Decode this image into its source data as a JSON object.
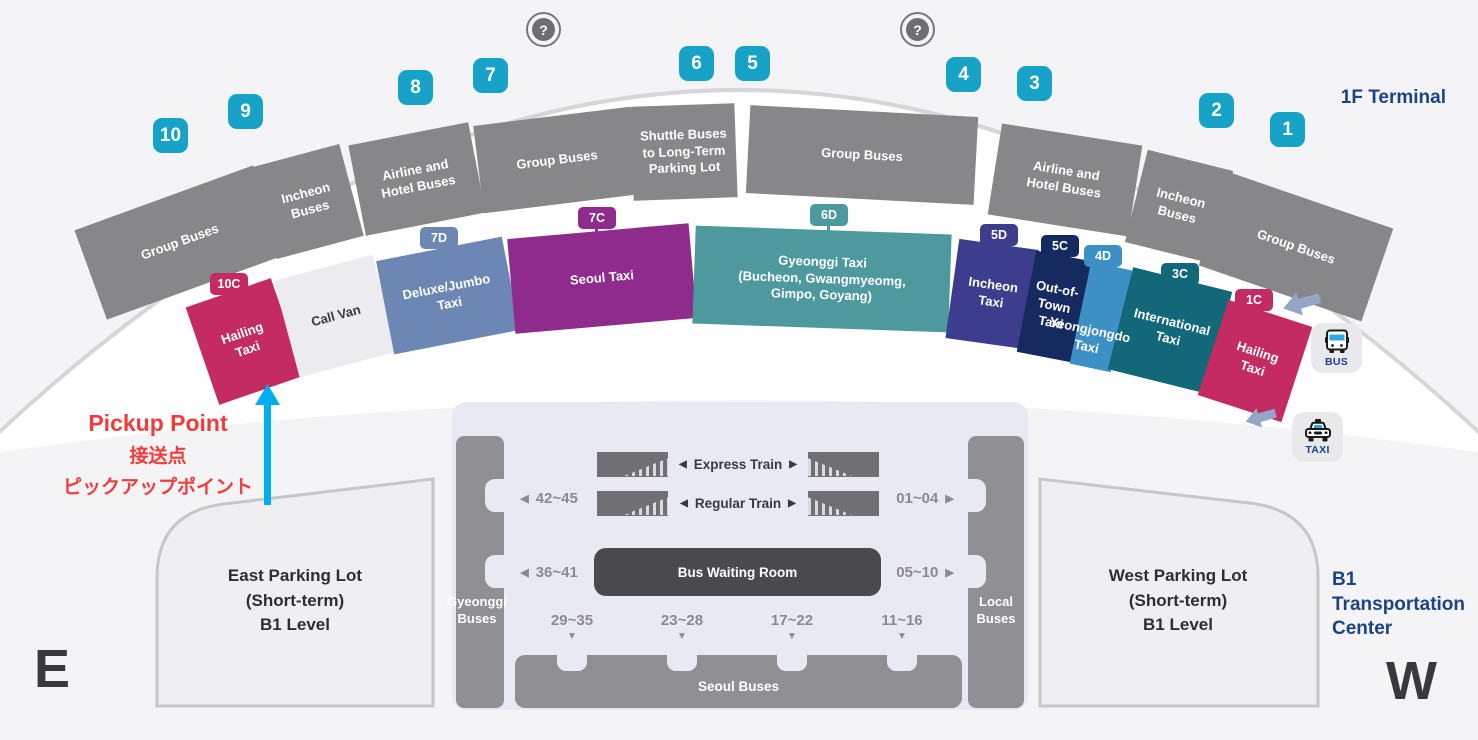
{
  "page": {
    "terminal_label": "1F Terminal",
    "transportation_center_label": "B1 Transportation Center",
    "compass_east": "E",
    "compass_west": "W"
  },
  "glyphs": {
    "question": "?",
    "left_arrow": "◀",
    "right_arrow": "▶",
    "down_arrow": "▼"
  },
  "door_numbers": [
    "10",
    "9",
    "8",
    "7",
    "6",
    "5",
    "4",
    "3",
    "2",
    "1"
  ],
  "bus_zones": [
    {
      "label": "Group Buses"
    },
    {
      "label": "Incheon Buses"
    },
    {
      "label": "Airline and Hotel Buses"
    },
    {
      "label": "Group Buses"
    },
    {
      "label": "Shuttle Buses to Long-Term Parking Lot"
    },
    {
      "label": "Group Buses"
    },
    {
      "label": "Airline and Hotel Buses"
    },
    {
      "label": "Incheon Buses"
    },
    {
      "label": "Group Buses"
    }
  ],
  "taxi_zones": [
    {
      "gate": "10C",
      "label": "Hailing Taxi",
      "color": "#C42B63"
    },
    {
      "gate": "",
      "label": "Call Van",
      "color": "#ECECF0"
    },
    {
      "gate": "7D",
      "label": "Deluxe/Jumbo Taxi",
      "color": "#6C87B4"
    },
    {
      "gate": "7C",
      "label": "Seoul Taxi",
      "color": "#8E2B8C"
    },
    {
      "gate": "6D",
      "label": "Gyeonggi Taxi (Bucheon, Gwangmyeomg, Gimpo, Goyang)",
      "label_lines": [
        "Gyeonggi Taxi",
        "(Bucheon, Gwangmyeomg,",
        "Gimpo, Goyang)"
      ],
      "color": "#4E999E"
    },
    {
      "gate": "5D",
      "label": "Incheon Taxi",
      "color": "#3C3E8D"
    },
    {
      "gate": "5C",
      "label": "Out-of-Town Taxi",
      "color": "#152A5F"
    },
    {
      "gate": "4D",
      "label": "Yeongjongdo Taxi",
      "color": "#3C90C3"
    },
    {
      "gate": "3C",
      "label": "International Taxi",
      "color": "#126878"
    },
    {
      "gate": "1C",
      "label": "Hailing Taxi",
      "color": "#C42B63"
    }
  ],
  "pickup": {
    "title": "Pickup Point",
    "subtitle_zh": "接送点",
    "subtitle_ja": "ピックアップポイント"
  },
  "vehicle_icons": {
    "bus_label": "BUS",
    "taxi_label": "TAXI"
  },
  "transportation_center": {
    "trains": [
      {
        "label": "Express Train"
      },
      {
        "label": "Regular Train"
      }
    ],
    "gate_ranges": {
      "left_top": "42~45",
      "left_bottom": "36~41",
      "right_top": "01~04",
      "right_bottom": "05~10"
    },
    "bus_waiting_room": "Bus Waiting Room",
    "left_column_label": "Gyeonggi Buses",
    "right_column_label": "Local Buses",
    "platform_ranges": [
      "29~35",
      "23~28",
      "17~22",
      "11~16"
    ],
    "seoul_buses_label": "Seoul Buses"
  },
  "parking": {
    "east_lines": [
      "East Parking Lot",
      "(Short-term)",
      "B1 Level"
    ],
    "west_lines": [
      "West Parking Lot",
      "(Short-term)",
      "B1 Level"
    ]
  },
  "colors": {
    "door_badge": "#17A3C8",
    "bus_zone_gray": "#87878A",
    "header_blue": "#1A4483",
    "pickup_red": "#F23B3B",
    "pickup_arrow_cyan": "#00AEEF",
    "direction_arrow_slate": "#93A6C7",
    "building_bg": "#E9E9F1",
    "column_gray": "#909094",
    "bus_waiting_room_dark": "#4A4A4E"
  }
}
